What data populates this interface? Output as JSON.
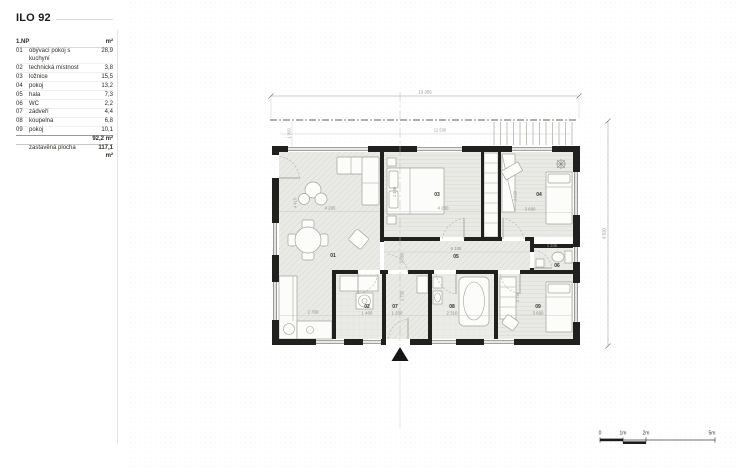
{
  "title": "ILO 92",
  "legend": {
    "floor_label": "1.NP",
    "unit_label": "m²",
    "rows": [
      {
        "num": "01",
        "name": "obývací pokoj s kuchyní",
        "area": "28,9"
      },
      {
        "num": "02",
        "name": "technická místnost",
        "area": "3,8"
      },
      {
        "num": "03",
        "name": "ložnice",
        "area": "15,5"
      },
      {
        "num": "04",
        "name": "pokoj",
        "area": "13,2"
      },
      {
        "num": "05",
        "name": "hala",
        "area": "7,3"
      },
      {
        "num": "06",
        "name": "WC",
        "area": "2,2"
      },
      {
        "num": "07",
        "name": "zádveří",
        "area": "4,4"
      },
      {
        "num": "08",
        "name": "koupelna",
        "area": "6,8"
      },
      {
        "num": "09",
        "name": "pokoj",
        "area": "10,1"
      }
    ],
    "total_area": "92,2 m²",
    "built_label": "zastavěná plocha",
    "built_area": "117,1 m²"
  },
  "plan": {
    "room_labels": {
      "r01": "01",
      "r02": "02",
      "r03": "03",
      "r04": "04",
      "r05": "05",
      "r06": "06",
      "r07": "07",
      "r08": "08",
      "r09": "09"
    },
    "dimensions": {
      "overall_width": "13 355",
      "inner_width": "12 530",
      "roof_overhang": "1 000",
      "overall_height": "9 520",
      "living_width": "4 265",
      "living_height": "4 410",
      "kitchen_width": "2 700",
      "bed3_width": "4 280",
      "bed3_depth": "1 480",
      "room4_width": "3 660",
      "room4_height": "3 620",
      "hall_width": "6 105",
      "hall_height": "1 080",
      "tech_width": "1 400",
      "entry_width": "1 200",
      "entry_height": "1 730",
      "bath_width": "2 310",
      "wc_width": "1 345",
      "room9_width": "3 660",
      "room9_height": "2 750"
    }
  },
  "scale_bar": {
    "t0": "0",
    "t1": "1m",
    "t2": "2m",
    "t5": "5m"
  },
  "colors": {
    "wall": "#20201e",
    "floor": "#e9e9e5",
    "dim_text": "#8d8d87"
  }
}
